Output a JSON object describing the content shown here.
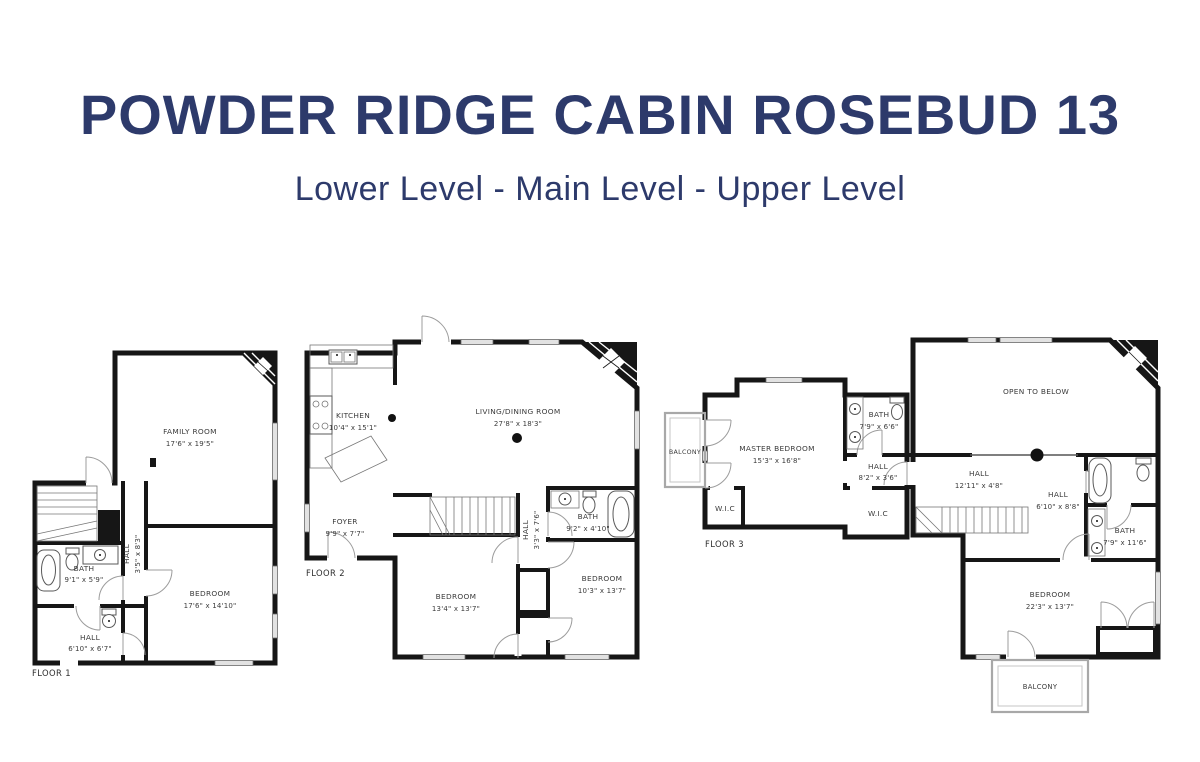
{
  "header": {
    "title": "POWDER RIDGE CABIN ROSEBUD 13",
    "subtitle": "Lower Level - Main Level - Upper Level"
  },
  "colors": {
    "title_navy": "#2d3a6b",
    "walls": "#161616",
    "label_text": "#3b3b3b"
  },
  "floors": {
    "f1": {
      "label": "FLOOR 1",
      "rooms": {
        "family": {
          "name": "FAMILY ROOM",
          "dims": "17'6\" x 19'5\""
        },
        "hall_upper": {
          "name": "HALL",
          "dims": "3'5\" x 8'3\""
        },
        "bath": {
          "name": "BATH",
          "dims": "9'1\" x 5'9\""
        },
        "bedroom": {
          "name": "BEDROOM",
          "dims": "17'6\" x 14'10\""
        },
        "hall_lower": {
          "name": "HALL",
          "dims": "6'10\" x 6'7\""
        }
      }
    },
    "f2": {
      "label": "FLOOR 2",
      "rooms": {
        "kitchen": {
          "name": "KITCHEN",
          "dims": "10'4\" x 15'1\""
        },
        "living": {
          "name": "LIVING/DINING ROOM",
          "dims": "27'8\" x 18'3\""
        },
        "foyer": {
          "name": "FOYER",
          "dims": "9'9\" x 7'7\""
        },
        "bath": {
          "name": "BATH",
          "dims": "9'2\" x 4'10\""
        },
        "hall": {
          "name": "HALL",
          "dims": "3'3\" x 7'6\""
        },
        "bedroom_left": {
          "name": "BEDROOM",
          "dims": "13'4\" x 13'7\""
        },
        "bedroom_right": {
          "name": "BEDROOM",
          "dims": "10'3\" x 13'7\""
        }
      }
    },
    "f3": {
      "label": "FLOOR 3",
      "rooms": {
        "balcony_upper": {
          "name": "BALCONY"
        },
        "master": {
          "name": "MASTER BEDROOM",
          "dims": "15'3\" x 16'8\""
        },
        "master_bath": {
          "name": "BATH",
          "dims": "7'9\" x 6'6\""
        },
        "master_hall": {
          "name": "HALL",
          "dims": "8'2\" x 3'6\""
        },
        "wic_left": {
          "name": "W.I.C"
        },
        "wic_right": {
          "name": "W.I.C"
        },
        "open_below": {
          "name": "OPEN TO BELOW"
        },
        "hall_main": {
          "name": "HALL",
          "dims": "12'11\" x 4'8\""
        },
        "hall_lower": {
          "name": "HALL",
          "dims": "6'10\" x 8'8\""
        },
        "bath_main": {
          "name": "BATH",
          "dims": "7'9\" x 11'6\""
        },
        "bedroom": {
          "name": "BEDROOM",
          "dims": "22'3\" x 13'7\""
        },
        "balcony_lower": {
          "name": "BALCONY"
        }
      }
    }
  }
}
